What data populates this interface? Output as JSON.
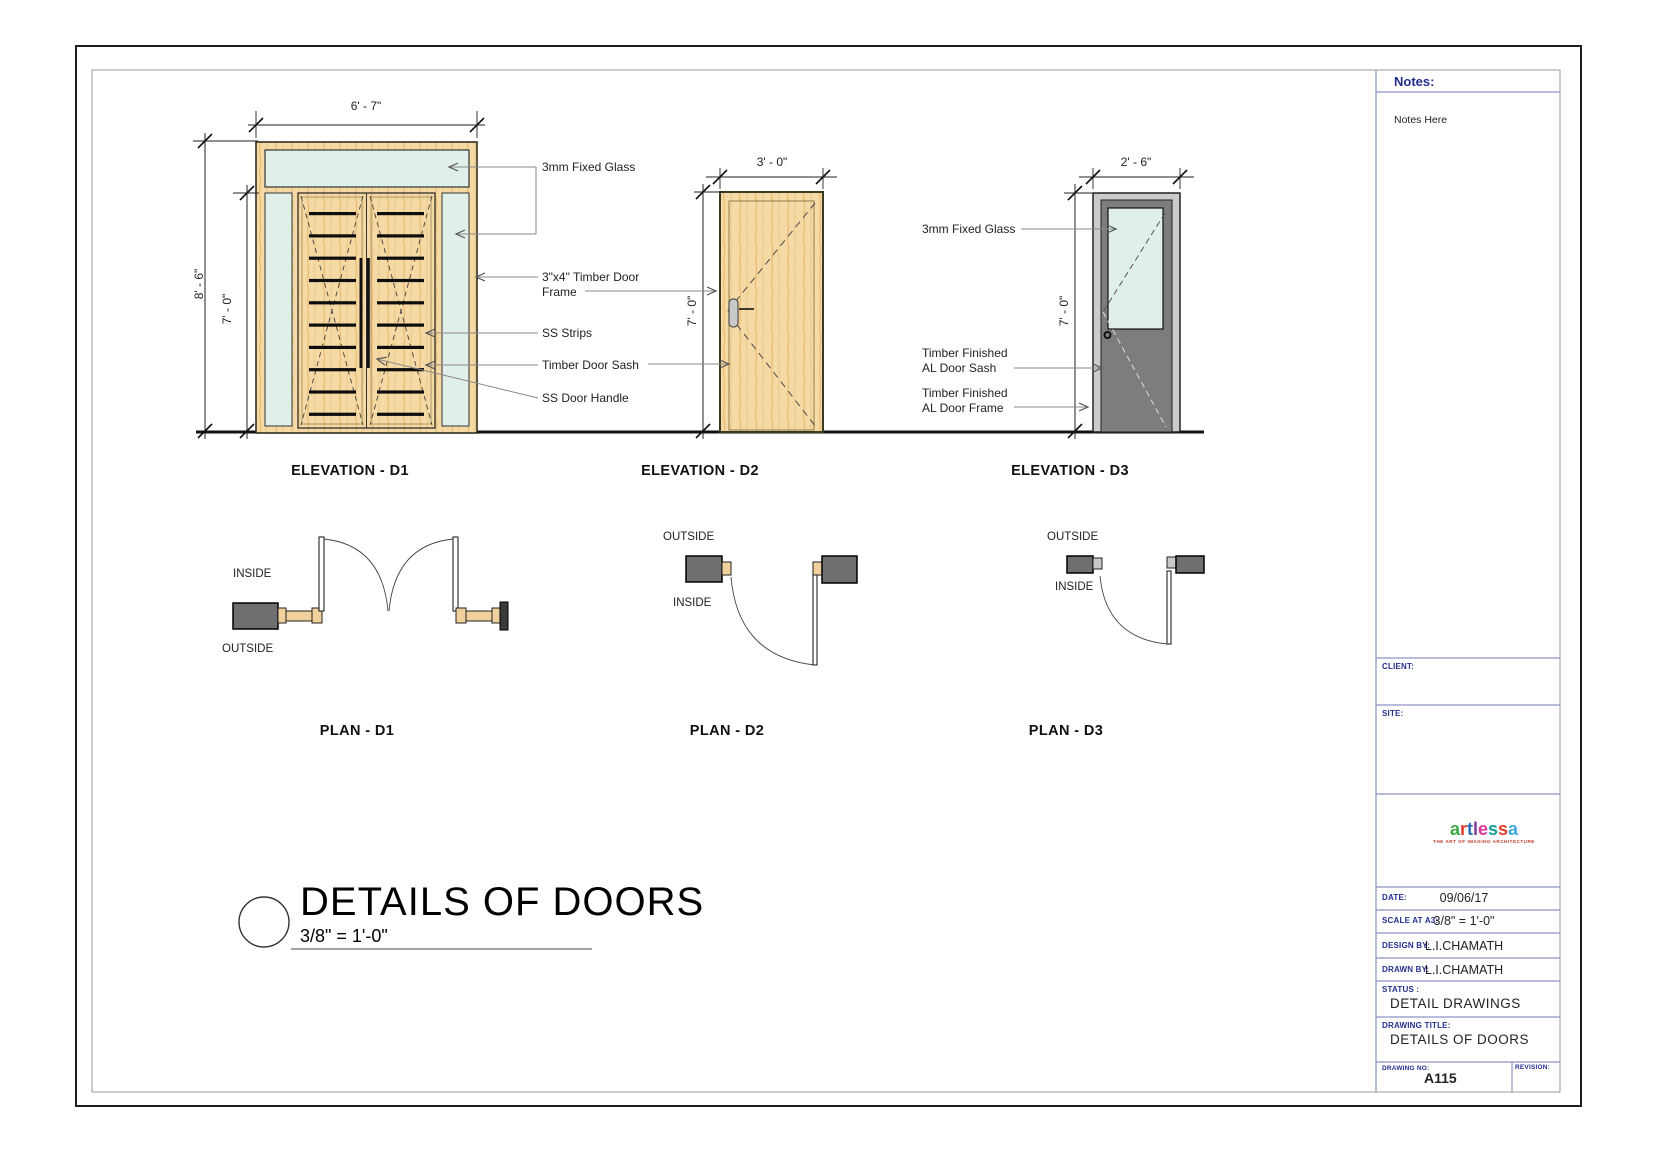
{
  "colors": {
    "wood": "#f6daa6",
    "wood_grain": "#e9c27e",
    "glass": "#e1efe9",
    "al_frame": "#cbcbcb",
    "al_sash": "#7d7d7d",
    "plan_wall": "#6f6f6f",
    "titleblock_line": "#8d92c5",
    "navy_label": "#232f8e"
  },
  "drawing": {
    "elevations": [
      {
        "caption": "ELEVATION - D1",
        "width_dim": "6' - 7\"",
        "total_height_dim": "8' - 6\"",
        "door_height_dim": "7' - 0\""
      },
      {
        "caption": "ELEVATION - D2",
        "width_dim": "3' - 0\"",
        "door_height_dim": "7' - 0\""
      },
      {
        "caption": "ELEVATION - D3",
        "width_dim": "2' - 6\"",
        "door_height_dim": "7' - 0\""
      }
    ],
    "plans": [
      {
        "caption": "PLAN - D1",
        "inside_label": "INSIDE",
        "outside_label": "OUTSIDE"
      },
      {
        "caption": "PLAN - D2",
        "inside_label": "INSIDE",
        "outside_label": "OUTSIDE"
      },
      {
        "caption": "PLAN - D3",
        "inside_label": "INSIDE",
        "outside_label": "OUTSIDE"
      }
    ],
    "callouts": {
      "d1_fixed_glass": "3mm Fixed Glass",
      "d1_frame_1": "3\"x4\" Timber Door",
      "d1_frame_2": "Frame",
      "d1_ss_strips": "SS Strips",
      "d1_sash": "Timber Door Sash",
      "d1_handle": "SS Door Handle",
      "d3_fixed_glass": "3mm Fixed Glass",
      "d3_sash_1": "Timber Finished",
      "d3_sash_2": "AL Door Sash",
      "d3_frame_1": "Timber Finished",
      "d3_frame_2": "AL Door Frame"
    },
    "sheet_title": {
      "text": "DETAILS OF DOORS",
      "scale": "3/8\" = 1'-0\""
    }
  },
  "titleblock": {
    "notes_label": "Notes:",
    "notes_value": "Notes Here",
    "client_label": "CLIENT:",
    "site_label": "SITE:",
    "logo": {
      "letters": [
        "a",
        "r",
        "t",
        "l",
        "e",
        "s",
        "s",
        "a"
      ],
      "letter_colors": [
        "#3faa44",
        "#e43b2c",
        "#2b6cb8",
        "#7a3f98",
        "#e0379b",
        "#159f97",
        "#e43b2c",
        "#3fa9dc"
      ],
      "tagline": "THE ART OF IMAGING ARCHITECTURE"
    },
    "rows": [
      {
        "label": "DATE:",
        "value": "09/06/17"
      },
      {
        "label": "SCALE AT A3:",
        "value": "3/8\" = 1'-0\""
      },
      {
        "label": "DESIGN BY:",
        "value": "L.I.CHAMATH"
      },
      {
        "label": "DRAWN BY:",
        "value": "L.I.CHAMATH"
      }
    ],
    "status_label": "STATUS :",
    "status_value": "DETAIL DRAWINGS",
    "drawing_title_label": "DRAWING TITLE:",
    "drawing_title_value": "DETAILS OF DOORS",
    "drawing_no_label": "DRAWING NO:",
    "drawing_no_value": "A115",
    "revision_label": "REVISION:"
  }
}
